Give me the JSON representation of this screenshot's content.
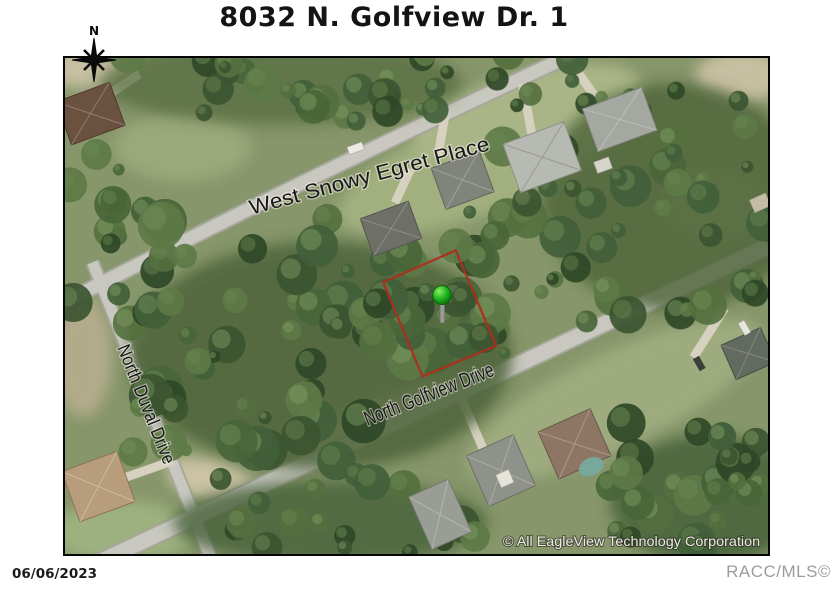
{
  "page": {
    "title": "8032 N. Golfview Dr. 1"
  },
  "map": {
    "compass_label": "N",
    "streets": [
      {
        "id": "west-snowy-egret-place",
        "name": "West Snowy Egret Place"
      },
      {
        "id": "north-duval-drive",
        "name": "North Duval Drive"
      },
      {
        "id": "north-golfview-drive",
        "name": "North Golfview Drive"
      }
    ],
    "copyright": "© All EagleView Technology Corporation",
    "parcel": {
      "outline_color": "#ad2f1c"
    },
    "marker": {
      "color": "#1fb41f"
    }
  },
  "footer": {
    "date": "06/06/2023",
    "credit": "RACC/MLS©"
  }
}
